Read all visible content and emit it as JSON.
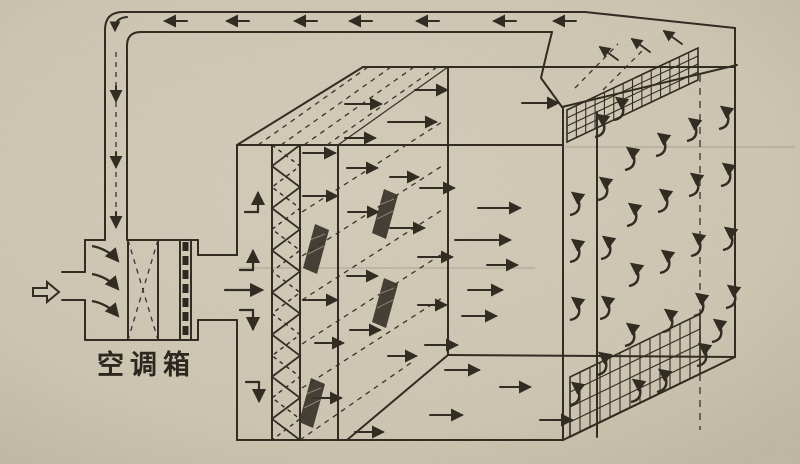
{
  "diagram": {
    "ahu_label": "空调箱",
    "colors": {
      "paper": "#cfc8b4",
      "paper_edge": "#c0b8a2",
      "ink": "#332c22",
      "blob": "#3a332a"
    },
    "return_duct": {
      "left_arrows_x": [
        165,
        227,
        295,
        350,
        417,
        494,
        554
      ],
      "left_arrows_y": 21,
      "down_arrows_x": 116,
      "down_arrows_y": [
        86,
        152,
        212
      ]
    },
    "hood_arrows": [
      [
        618,
        60,
        600,
        47
      ],
      [
        650,
        52,
        632,
        39
      ],
      [
        682,
        44,
        664,
        31
      ]
    ],
    "plenum_flow": [
      {
        "x": 245,
        "y": 212,
        "dir": "up"
      },
      {
        "x": 240,
        "y": 270,
        "dir": "up"
      },
      {
        "x": 225,
        "y": 290,
        "dir": "right",
        "len": 37
      },
      {
        "x": 240,
        "y": 310,
        "dir": "down"
      },
      {
        "x": 246,
        "y": 382,
        "dir": "down"
      }
    ],
    "mixing_arcs": [
      [
        92,
        246
      ],
      [
        92,
        274
      ],
      [
        92,
        301
      ]
    ],
    "room_arrows": [
      [
        345,
        104,
        36
      ],
      [
        415,
        90,
        32
      ],
      [
        522,
        103,
        36
      ],
      [
        388,
        122,
        48
      ],
      [
        345,
        138,
        30
      ],
      [
        303,
        153,
        32
      ],
      [
        347,
        168,
        30
      ],
      [
        390,
        177,
        28
      ],
      [
        420,
        188,
        34
      ],
      [
        303,
        196,
        34
      ],
      [
        348,
        212,
        30
      ],
      [
        478,
        208,
        42
      ],
      [
        390,
        228,
        34
      ],
      [
        455,
        240,
        55
      ],
      [
        418,
        257,
        34
      ],
      [
        487,
        265,
        30
      ],
      [
        347,
        276,
        30
      ],
      [
        468,
        290,
        34
      ],
      [
        303,
        300,
        34
      ],
      [
        418,
        305,
        28
      ],
      [
        462,
        316,
        34
      ],
      [
        350,
        330,
        30
      ],
      [
        315,
        343,
        28
      ],
      [
        425,
        345,
        32
      ],
      [
        388,
        356,
        28
      ],
      [
        445,
        370,
        34
      ],
      [
        500,
        387,
        30
      ],
      [
        313,
        398,
        28
      ],
      [
        430,
        415,
        32
      ],
      [
        355,
        432,
        28
      ],
      [
        540,
        420,
        32
      ]
    ],
    "curl_arrows": [
      [
        573,
        205
      ],
      [
        573,
        252
      ],
      [
        573,
        310
      ],
      [
        573,
        395
      ],
      [
        598,
        127
      ],
      [
        601,
        190
      ],
      [
        604,
        249
      ],
      [
        603,
        309
      ],
      [
        600,
        365
      ],
      [
        617,
        110
      ],
      [
        628,
        160
      ],
      [
        630,
        216
      ],
      [
        632,
        276
      ],
      [
        628,
        336
      ],
      [
        634,
        392
      ],
      [
        659,
        146
      ],
      [
        661,
        202
      ],
      [
        663,
        263
      ],
      [
        666,
        322
      ],
      [
        660,
        382
      ],
      [
        690,
        131
      ],
      [
        692,
        186
      ],
      [
        694,
        246
      ],
      [
        697,
        306
      ],
      [
        700,
        356
      ],
      [
        722,
        119
      ],
      [
        724,
        176
      ],
      [
        726,
        240
      ],
      [
        729,
        298
      ],
      [
        715,
        332
      ]
    ],
    "blobs": [
      [
        316,
        248
      ],
      [
        385,
        213
      ],
      [
        385,
        302
      ],
      [
        312,
        402
      ]
    ],
    "zigzag": {
      "x_left": 272,
      "x_right": 300,
      "y_top": 145,
      "y_bottom": 440,
      "segments": 14
    },
    "grilles": [
      {
        "name": "top-return-grille",
        "tl": [
          567,
          110
        ],
        "tr": [
          698,
          48
        ],
        "bl": [
          567,
          142
        ],
        "rails": 3,
        "ticks": 13
      },
      {
        "name": "bottom-return-grille",
        "tl": [
          570,
          377
        ],
        "tr": [
          700,
          314
        ],
        "bl": [
          570,
          437
        ],
        "rails": 3,
        "ticks": 12
      }
    ]
  }
}
